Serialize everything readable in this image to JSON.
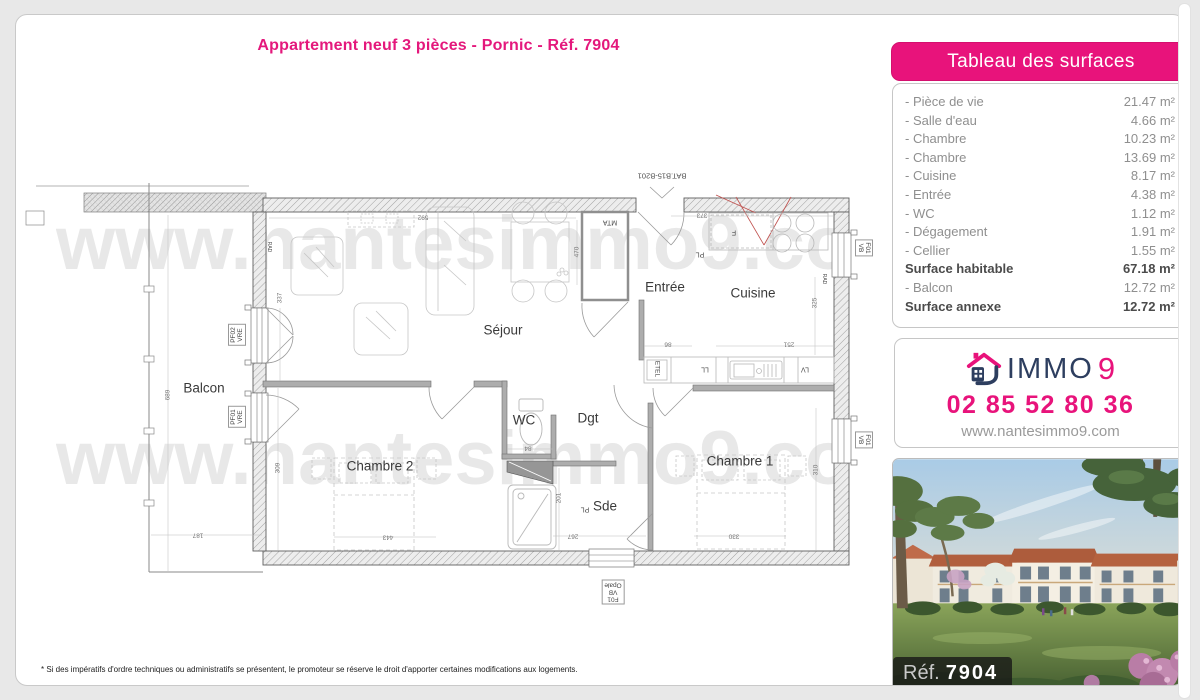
{
  "page": {
    "title": "Appartement neuf 3 pièces - Pornic - Réf. 7904",
    "watermark": "www.nantesimmo9.com",
    "footnote": "* Si des impératifs d'ordre techniques ou administratifs se présentent, le promoteur se réserve le droit d'apporter certaines modifications aux logements."
  },
  "colors": {
    "accent_pink": "#e8137b",
    "brand_navy": "#2d3e5f"
  },
  "surface_table": {
    "header": "Tableau des surfaces",
    "rows": [
      {
        "label": "- Pièce de vie",
        "value": "21.47 m²",
        "bold": false
      },
      {
        "label": "- Salle d'eau",
        "value": "4.66 m²",
        "bold": false
      },
      {
        "label": "- Chambre",
        "value": "10.23 m²",
        "bold": false
      },
      {
        "label": "- Chambre",
        "value": "13.69 m²",
        "bold": false
      },
      {
        "label": "- Cuisine",
        "value": "8.17 m²",
        "bold": false
      },
      {
        "label": "- Entrée",
        "value": "4.38 m²",
        "bold": false
      },
      {
        "label": "- WC",
        "value": "1.12 m²",
        "bold": false
      },
      {
        "label": "- Dégagement",
        "value": "1.91 m²",
        "bold": false
      },
      {
        "label": "- Cellier",
        "value": "1.55 m²",
        "bold": false
      },
      {
        "label": "Surface habitable",
        "value": "67.18 m²",
        "bold": true
      },
      {
        "label": "- Balcon",
        "value": "12.72 m²",
        "bold": false
      },
      {
        "label": "Surface annexe",
        "value": "12.72 m²",
        "bold": true
      }
    ]
  },
  "agency": {
    "brand_immo": "IMMO",
    "brand_9": "9",
    "phone": "02 85 52 80 36",
    "website": "www.nantesimmo9.com"
  },
  "photo": {
    "ref_label": "Réf.",
    "ref_number": "7904"
  },
  "floorplan": {
    "rooms": [
      {
        "label": "Balcon",
        "x": 188,
        "y": 373
      },
      {
        "label": "Séjour",
        "x": 487,
        "y": 315
      },
      {
        "label": "Entrée",
        "x": 649,
        "y": 272
      },
      {
        "label": "Cuisine",
        "x": 737,
        "y": 278
      },
      {
        "label": "WC",
        "x": 508,
        "y": 405
      },
      {
        "label": "Dgt",
        "x": 572,
        "y": 403
      },
      {
        "label": "Sde",
        "x": 589,
        "y": 491
      },
      {
        "label": "Chambre 2",
        "x": 364,
        "y": 451
      },
      {
        "label": "Chambre 1",
        "x": 724,
        "y": 446
      }
    ],
    "tags": [
      {
        "label": "BAT.B15-B201",
        "x": 646,
        "y": 161,
        "rot": 180,
        "size": 7.5
      },
      {
        "label": "MTA",
        "x": 594,
        "y": 207,
        "rot": 180,
        "size": 7
      },
      {
        "label": "PL",
        "x": 684,
        "y": 239,
        "rot": 180,
        "size": 7
      },
      {
        "label": "F",
        "x": 718,
        "y": 217,
        "rot": 180,
        "size": 7
      },
      {
        "label": "ETEL",
        "x": 641,
        "y": 354,
        "rot": 90,
        "size": 6.5
      },
      {
        "label": "LL",
        "x": 689,
        "y": 354,
        "rot": 180,
        "size": 7
      },
      {
        "label": "LV",
        "x": 789,
        "y": 354,
        "rot": 180,
        "size": 7
      },
      {
        "label": "PL",
        "x": 569,
        "y": 494,
        "rot": 180,
        "size": 7
      },
      {
        "label": "RAD",
        "x": 253,
        "y": 232,
        "rot": 90,
        "size": 5
      },
      {
        "label": "RAD",
        "x": 808,
        "y": 264,
        "rot": 90,
        "size": 5
      }
    ],
    "window_tags": [
      {
        "lines": [
          "PF02",
          "VRE"
        ],
        "x": 221,
        "y": 320,
        "rot": -90
      },
      {
        "lines": [
          "PF01",
          "VRE"
        ],
        "x": 221,
        "y": 402,
        "rot": -90
      },
      {
        "lines": [
          "F01",
          "VB"
        ],
        "x": 848,
        "y": 233,
        "rot": 90
      },
      {
        "lines": [
          "F01",
          "VB"
        ],
        "x": 848,
        "y": 425,
        "rot": 90
      },
      {
        "lines": [
          "F01",
          "VB",
          "Opale"
        ],
        "x": 597,
        "y": 577,
        "rot": 180
      }
    ],
    "dimensions": [
      {
        "label": "689",
        "x": 152,
        "y": 380,
        "rot": -90
      },
      {
        "label": "187",
        "x": 182,
        "y": 520,
        "rot": 180
      },
      {
        "label": "337",
        "x": 264,
        "y": 283,
        "rot": -90
      },
      {
        "label": "592",
        "x": 407,
        "y": 202,
        "rot": 180
      },
      {
        "label": "470",
        "x": 561,
        "y": 237,
        "rot": -90
      },
      {
        "label": "373",
        "x": 686,
        "y": 200,
        "rot": 180
      },
      {
        "label": "325",
        "x": 799,
        "y": 288,
        "rot": -90
      },
      {
        "label": "86",
        "x": 652,
        "y": 329,
        "rot": 180
      },
      {
        "label": "251",
        "x": 773,
        "y": 329,
        "rot": 180
      },
      {
        "label": "309",
        "x": 262,
        "y": 453,
        "rot": -90
      },
      {
        "label": "443",
        "x": 372,
        "y": 522,
        "rot": 180
      },
      {
        "label": "84",
        "x": 512,
        "y": 433,
        "rot": 180
      },
      {
        "label": "201",
        "x": 543,
        "y": 483,
        "rot": -90
      },
      {
        "label": "267",
        "x": 557,
        "y": 521,
        "rot": 180
      },
      {
        "label": "330",
        "x": 718,
        "y": 521,
        "rot": 180
      },
      {
        "label": "310",
        "x": 800,
        "y": 455,
        "rot": -90
      }
    ]
  }
}
